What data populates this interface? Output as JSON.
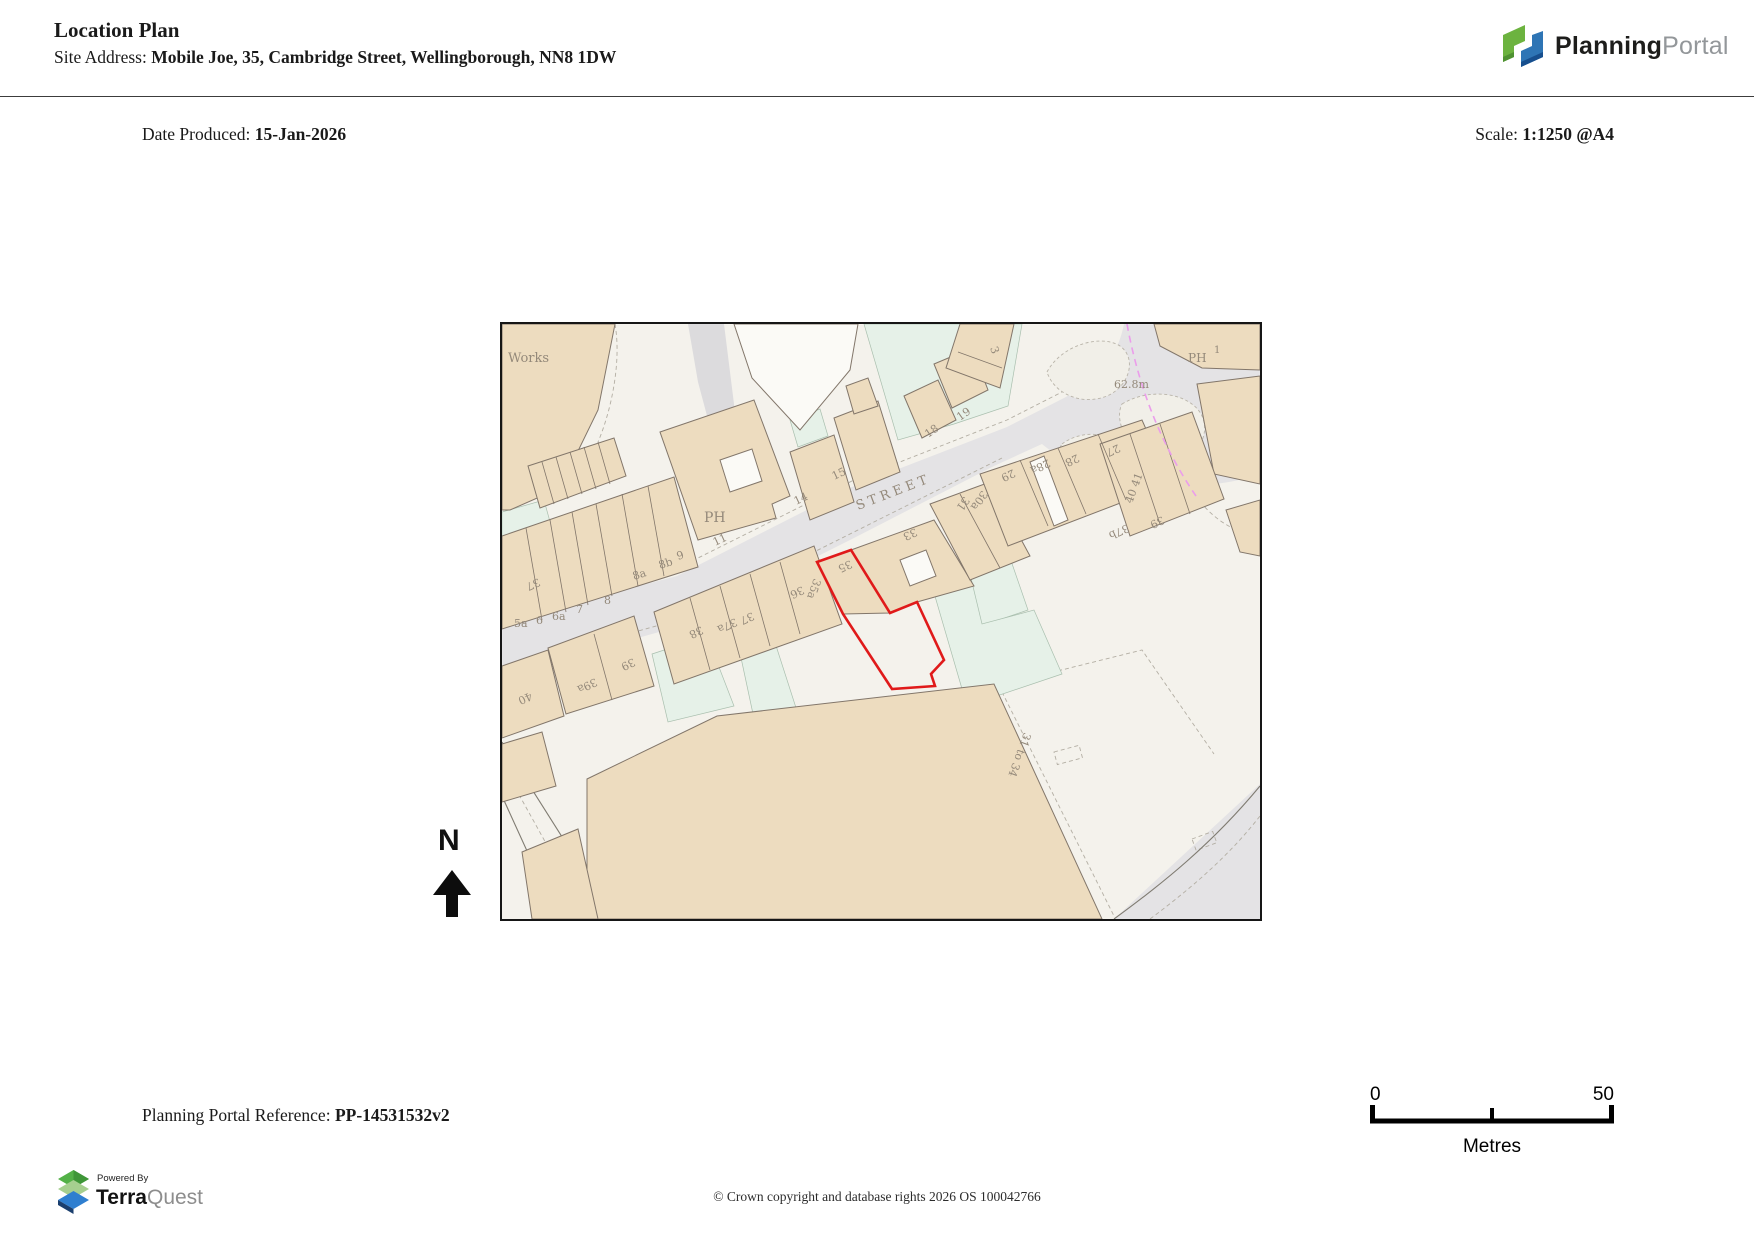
{
  "header": {
    "title": "Location Plan",
    "site_address_label": "Site Address: ",
    "site_address": "Mobile Joe, 35, Cambridge Street, Wellingborough, NN8 1DW"
  },
  "meta": {
    "date_label": "Date Produced: ",
    "date": "15-Jan-2026",
    "scale_label": "Scale: ",
    "scale": "1:1250 @A4"
  },
  "planning_portal_logo": {
    "brand_bold": "Planning",
    "brand_light": "Portal"
  },
  "north": {
    "label": "N"
  },
  "map": {
    "site_outline_color": "#e01a1a",
    "labels": [
      {
        "t": "Works",
        "x": 6,
        "y": 38,
        "r": 0,
        "s": 13
      },
      {
        "t": "PH",
        "x": 202,
        "y": 198,
        "r": 0,
        "s": 14
      },
      {
        "t": "11",
        "x": 213,
        "y": 222,
        "r": -25,
        "s": 11
      },
      {
        "t": "14",
        "x": 294,
        "y": 181,
        "r": -25,
        "s": 11
      },
      {
        "t": "15",
        "x": 332,
        "y": 156,
        "r": -25,
        "s": 11
      },
      {
        "t": "STREET",
        "x": 356,
        "y": 186,
        "r": -21,
        "s": 13,
        "ls": 4
      },
      {
        "t": "18",
        "x": 426,
        "y": 114,
        "r": -35,
        "s": 11
      },
      {
        "t": "19",
        "x": 458,
        "y": 97,
        "r": -35,
        "s": 11
      },
      {
        "t": "3",
        "x": 488,
        "y": 24,
        "r": 70,
        "s": 11
      },
      {
        "t": "62.8m",
        "x": 612,
        "y": 64,
        "r": 0,
        "s": 11
      },
      {
        "t": "PH",
        "x": 686,
        "y": 38,
        "r": 0,
        "s": 12
      },
      {
        "t": "1",
        "x": 712,
        "y": 29,
        "r": 0,
        "s": 10
      },
      {
        "t": "27",
        "x": 616,
        "y": 120,
        "r": 155,
        "s": 11
      },
      {
        "t": "28",
        "x": 575,
        "y": 130,
        "r": 155,
        "s": 11
      },
      {
        "t": "28a",
        "x": 546,
        "y": 135,
        "r": 155,
        "s": 11
      },
      {
        "t": "29",
        "x": 511,
        "y": 145,
        "r": 155,
        "s": 11
      },
      {
        "t": "30a",
        "x": 480,
        "y": 166,
        "r": 125,
        "s": 11
      },
      {
        "t": "31",
        "x": 462,
        "y": 172,
        "r": 125,
        "s": 11
      },
      {
        "t": "33",
        "x": 413,
        "y": 204,
        "r": 155,
        "s": 11
      },
      {
        "t": "35",
        "x": 348,
        "y": 236,
        "r": 155,
        "s": 11
      },
      {
        "t": "35a",
        "x": 312,
        "y": 254,
        "r": 110,
        "s": 11
      },
      {
        "t": "36",
        "x": 300,
        "y": 262,
        "r": 155,
        "s": 11
      },
      {
        "t": "37",
        "x": 250,
        "y": 288,
        "r": 155,
        "s": 11
      },
      {
        "t": "37a",
        "x": 233,
        "y": 294,
        "r": 155,
        "s": 11
      },
      {
        "t": "38",
        "x": 199,
        "y": 302,
        "r": 155,
        "s": 11
      },
      {
        "t": "39",
        "x": 131,
        "y": 334,
        "r": 155,
        "s": 11
      },
      {
        "t": "39a",
        "x": 93,
        "y": 354,
        "r": 155,
        "s": 11
      },
      {
        "t": "40",
        "x": 28,
        "y": 368,
        "r": 155,
        "s": 11
      },
      {
        "t": "37",
        "x": 36,
        "y": 254,
        "r": 155,
        "s": 11
      },
      {
        "t": "5a",
        "x": 12,
        "y": 303,
        "r": 0,
        "s": 11
      },
      {
        "t": "6",
        "x": 34,
        "y": 300,
        "r": 0,
        "s": 11
      },
      {
        "t": "6a",
        "x": 50,
        "y": 296,
        "r": 0,
        "s": 11
      },
      {
        "t": "7",
        "x": 74,
        "y": 289,
        "r": 0,
        "s": 11
      },
      {
        "t": "8",
        "x": 102,
        "y": 280,
        "r": 0,
        "s": 11
      },
      {
        "t": "8a",
        "x": 132,
        "y": 256,
        "r": -18,
        "s": 11
      },
      {
        "t": "8b",
        "x": 158,
        "y": 245,
        "r": -18,
        "s": 11
      },
      {
        "t": "9",
        "x": 176,
        "y": 236,
        "r": -18,
        "s": 11
      },
      {
        "t": "31 to 34",
        "x": 522,
        "y": 408,
        "r": 110,
        "s": 11
      },
      {
        "t": "37b",
        "x": 625,
        "y": 200,
        "r": 155,
        "s": 11
      },
      {
        "t": "39",
        "x": 660,
        "y": 192,
        "r": 155,
        "s": 11
      },
      {
        "t": "40 41",
        "x": 630,
        "y": 180,
        "r": -70,
        "s": 11
      }
    ]
  },
  "footer": {
    "reference_label": "Planning Portal Reference: ",
    "reference": "PP-14531532v2",
    "copyright": "© Crown copyright and database rights 2026 OS 100042766"
  },
  "scalebar": {
    "start": "0",
    "end": "50",
    "unit": "Metres"
  },
  "terraquest": {
    "powered_by": "Powered By",
    "brand_bold": "Terra",
    "brand_light": "Quest"
  }
}
